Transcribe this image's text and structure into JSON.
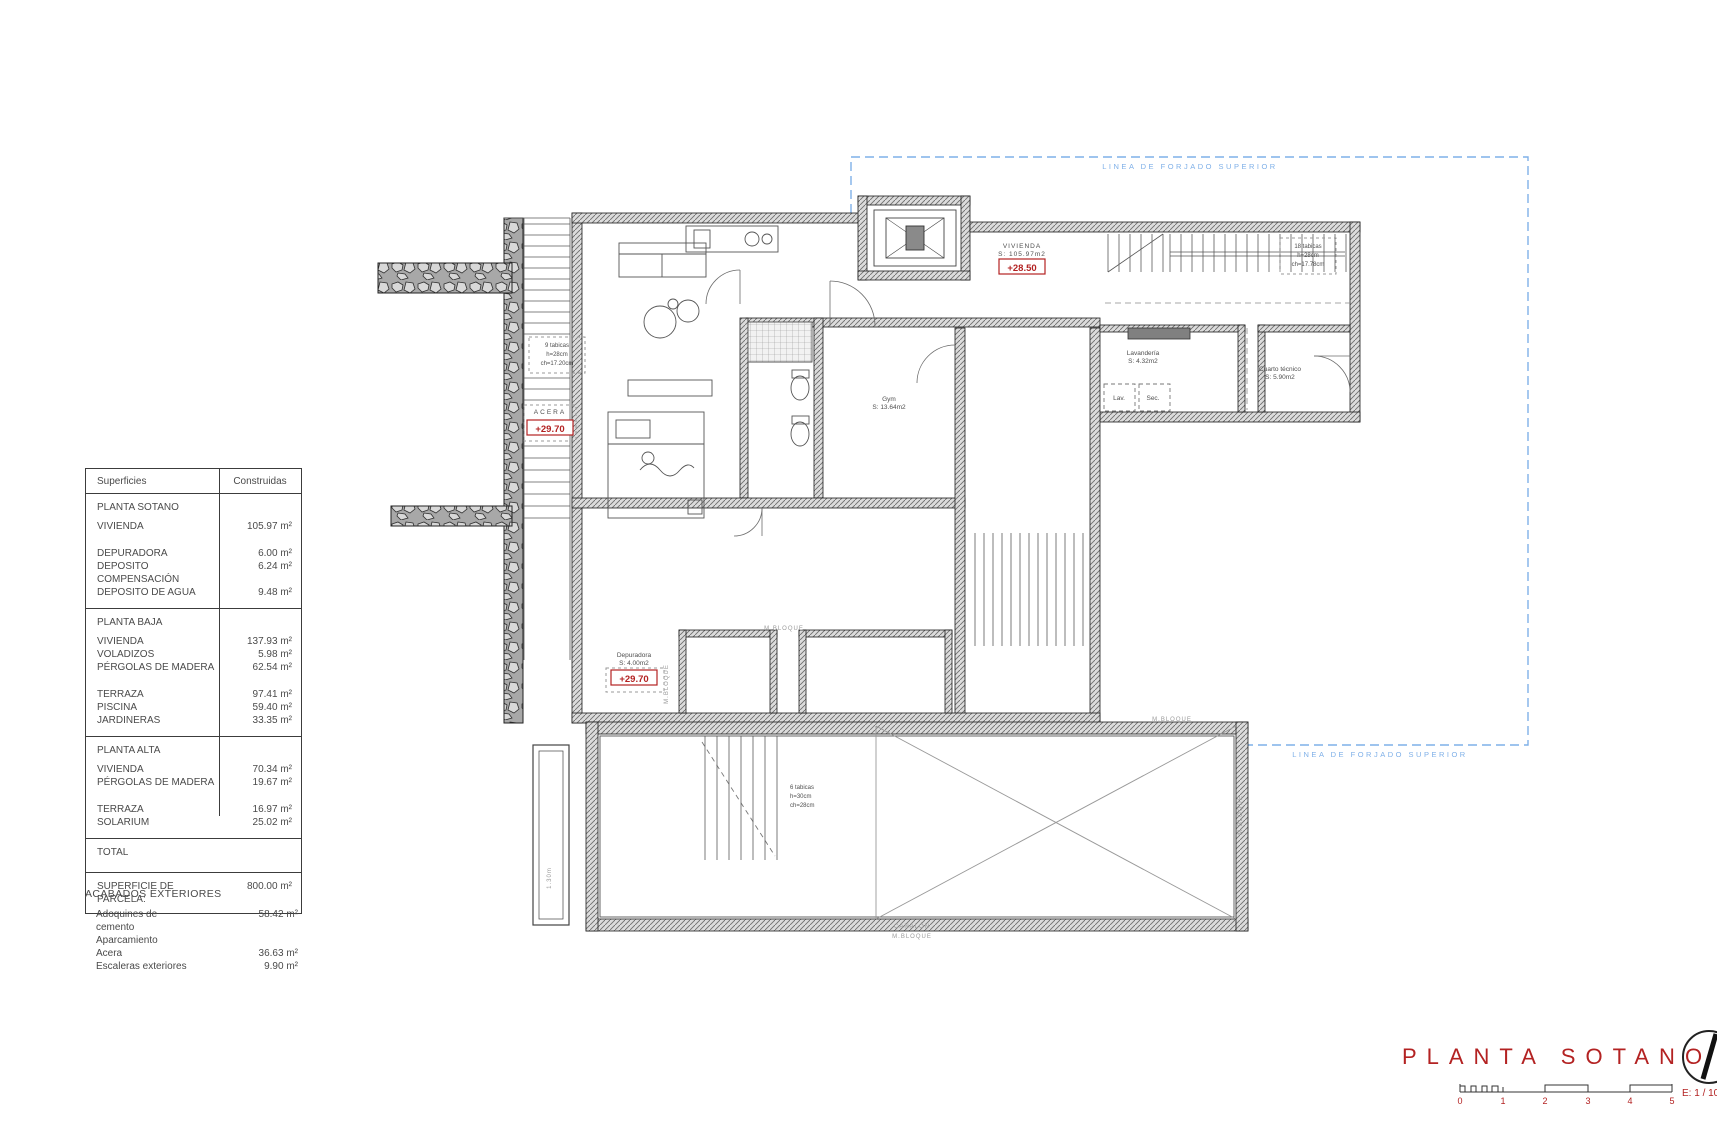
{
  "table": {
    "headers": [
      "Superficies",
      "Construidas"
    ],
    "sections": [
      {
        "name": "planta-sotano",
        "title": "PLANTA SOTANO",
        "rows": [
          {
            "l": "VIVIENDA",
            "v": "105.97 m²"
          },
          {
            "l": "DEPURADORA",
            "v": "6.00 m²",
            "sp": true
          },
          {
            "l": "DEPOSITO COMPENSACIÓN",
            "v": "6.24 m²"
          },
          {
            "l": "DEPOSITO DE AGUA",
            "v": "9.48 m²"
          }
        ]
      },
      {
        "name": "planta-baja",
        "title": "PLANTA BAJA",
        "rows": [
          {
            "l": "VIVIENDA",
            "v": "137.93 m²"
          },
          {
            "l": "VOLADIZOS",
            "v": "5.98 m²"
          },
          {
            "l": "PÉRGOLAS DE MADERA",
            "v": "62.54 m²"
          },
          {
            "l": "TERRAZA",
            "v": "97.41 m²",
            "sp": true
          },
          {
            "l": "PISCINA",
            "v": "59.40 m²"
          },
          {
            "l": "JARDINERAS",
            "v": "33.35 m²"
          }
        ]
      },
      {
        "name": "planta-alta",
        "title": "PLANTA ALTA",
        "rows": [
          {
            "l": "VIVIENDA",
            "v": "70.34 m²"
          },
          {
            "l": "PÉRGOLAS DE MADERA",
            "v": "19.67 m²"
          },
          {
            "l": "TERRAZA",
            "v": "16.97 m²",
            "sp": true
          },
          {
            "l": "SOLARIUM",
            "v": "25.02 m²"
          }
        ]
      },
      {
        "name": "total",
        "title": "TOTAL",
        "kind": "total",
        "rows": []
      },
      {
        "name": "parcela",
        "kind": "total",
        "rows": [
          {
            "l": "SUPERFICIE DE PARCELA:",
            "v": "800.00 m²"
          }
        ]
      }
    ]
  },
  "acabados": {
    "title": "ACABADOS EXTERIORES",
    "rows": [
      {
        "l": "Adoquines de cemento Aparcamiento",
        "v": "58.42 m²"
      },
      {
        "l": "Acera",
        "v": "36.63 m²"
      },
      {
        "l": "Escaleras exteriores",
        "v": "9.90 m²"
      }
    ]
  },
  "plan": {
    "forjado": {
      "label": "LINEA DE FORJADO SUPERIOR"
    },
    "room_labels": [
      {
        "name": "room-label-vivienda",
        "lines": [
          "VIVIENDA",
          "S: 105.97m2"
        ],
        "x": 1022,
        "y": 248,
        "ls": 1
      },
      {
        "name": "room-label-gym",
        "lines": [
          "Gym",
          "S: 13.64m2"
        ],
        "x": 889,
        "y": 401
      },
      {
        "name": "room-label-lavanderia",
        "lines": [
          "Lavandería",
          "S: 4.32m2"
        ],
        "x": 1143,
        "y": 355
      },
      {
        "name": "room-label-cuarto-tecnico",
        "lines": [
          "Cuarto técnico",
          "S: 5.90m2"
        ],
        "x": 1280,
        "y": 371
      },
      {
        "name": "room-label-depuradora",
        "lines": [
          "Depuradora",
          "S: 4.00m2"
        ],
        "x": 634,
        "y": 657
      },
      {
        "name": "room-label-lav",
        "lines": [
          "Lav."
        ],
        "x": 1119,
        "y": 400
      },
      {
        "name": "room-label-sec",
        "lines": [
          "Sec."
        ],
        "x": 1153,
        "y": 400
      },
      {
        "name": "room-label-acera",
        "lines": [
          "ACERA"
        ],
        "x": 550,
        "y": 414,
        "ls": 2
      }
    ],
    "level_badges": [
      {
        "name": "level-badge-vivienda",
        "text": "+28.50",
        "x": 1022,
        "y": 270
      },
      {
        "name": "level-badge-acera",
        "text": "+29.70",
        "x": 550,
        "y": 431
      },
      {
        "name": "level-badge-depuradora",
        "text": "+29.70",
        "x": 634,
        "y": 681
      }
    ],
    "stair_notes": [
      {
        "name": "stair-note-exterior",
        "lines": [
          "9 tabicas",
          "h=28cm",
          "ch=17.20cm"
        ],
        "x": 557,
        "y": 347,
        "box": true
      },
      {
        "name": "stair-note-interior",
        "lines": [
          "18 tabicas",
          "h=28cm",
          "ch=17.78cm"
        ],
        "x": 1308,
        "y": 248,
        "box": true
      },
      {
        "name": "stair-note-pool",
        "lines": [
          "6 tabicas",
          "h=30cm",
          "ch=28cm"
        ],
        "x": 790,
        "y": 789,
        "anchor": "start"
      }
    ],
    "small_labels": [
      {
        "name": "material-label",
        "text": "M.BLOQUE",
        "x": 784,
        "y": 630
      },
      {
        "name": "material-label",
        "text": "M.BLOQUE",
        "x": 1172,
        "y": 721
      },
      {
        "name": "canalon-label",
        "text": "CANALÓN",
        "x": 912,
        "y": 928
      },
      {
        "name": "material-label",
        "text": "M.BLOQUE",
        "x": 912,
        "y": 938
      },
      {
        "name": "material-label-vert",
        "text": "M.BLOQUE",
        "x": 668,
        "y": 684,
        "rot": -90
      },
      {
        "name": "material-label-vert",
        "text": "M.BLOQUE",
        "x": 1242,
        "y": 815,
        "rot": -90
      },
      {
        "name": "dim-label-vert",
        "text": "1.30m",
        "x": 551,
        "y": 878,
        "rot": -90
      }
    ]
  },
  "title_block": {
    "title": "PLANTA SOTANO",
    "scale_label": "E: 1 / 10",
    "ticks": [
      "0",
      "1",
      "2",
      "3",
      "4",
      "5"
    ]
  },
  "colors": {
    "red": "#b32222",
    "blue": "#7fb0e8",
    "grey": "#999999",
    "wall": "#222222"
  }
}
